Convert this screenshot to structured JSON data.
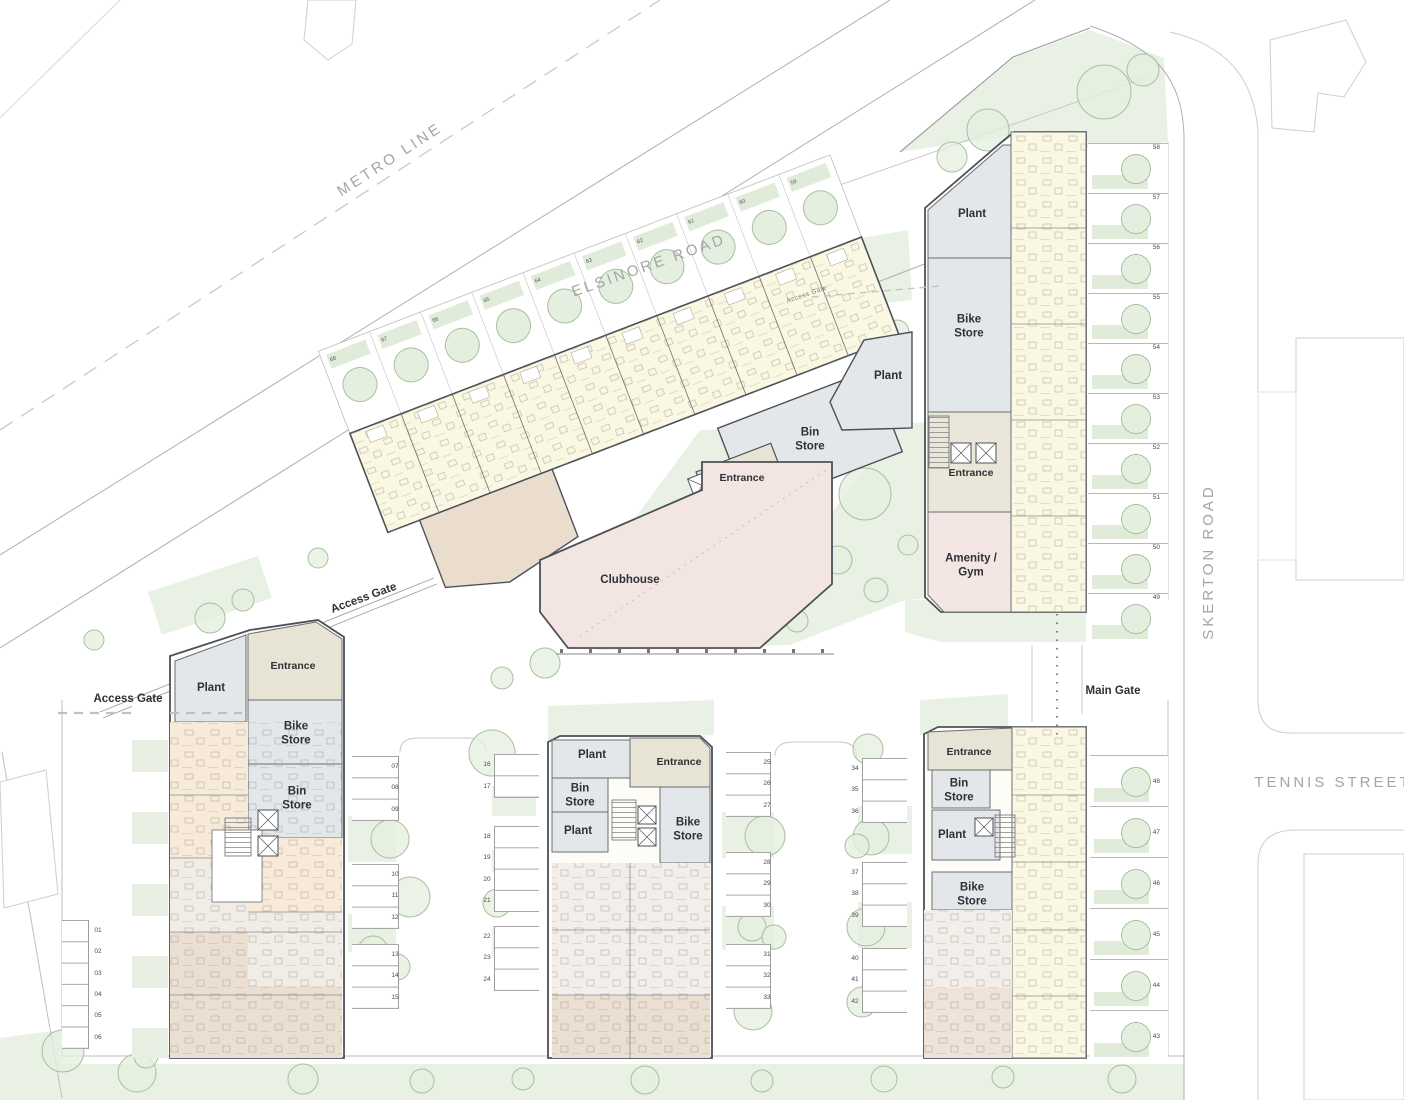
{
  "title": "Residential development site plan",
  "streets": {
    "metro": "METRO LINE",
    "elsinore": "ELSINORE ROAD",
    "skerton": "SKERTON ROAD",
    "tennis": "TENNIS STREET"
  },
  "gates": {
    "access_elsinore": "Access Gate",
    "access_west_path": "Access Gate",
    "access_west": "Access Gate",
    "main": "Main Gate"
  },
  "blocks": {
    "north_east": {
      "plant": "Plant",
      "bike_store": "Bike Store",
      "entrance": "Entrance",
      "amenity": "Amenity / Gym"
    },
    "terrace": {
      "plant": "Plant",
      "bin_store": "Bin Store",
      "entrance": "Entrance",
      "clubhouse": "Clubhouse"
    },
    "west": {
      "plant": "Plant",
      "entrance": "Entrance",
      "bike_store": "Bike Store",
      "bin_store": "Bin Store"
    },
    "central": {
      "plant_a": "Plant",
      "entrance": "Entrance",
      "bin_store": "Bin Store",
      "plant_b": "Plant",
      "bike_store": "Bike Store"
    },
    "south_east": {
      "entrance": "Entrance",
      "bin_store": "Bin Store",
      "plant": "Plant",
      "bike_store": "Bike Store"
    }
  },
  "parking": {
    "lane_a": [
      "01",
      "02",
      "03",
      "04",
      "05",
      "06"
    ],
    "lane_b1": [
      "07",
      "08",
      "09"
    ],
    "lane_b2": [
      "10",
      "11",
      "12"
    ],
    "lane_b3": [
      "13",
      "14",
      "15"
    ],
    "lane_c1": [
      "16",
      "17"
    ],
    "lane_c2": [
      "18",
      "19",
      "20",
      "21"
    ],
    "lane_c3": [
      "22",
      "23",
      "24"
    ],
    "lane_d1": [
      "25",
      "26",
      "27"
    ],
    "lane_d2": [
      "28",
      "29",
      "30"
    ],
    "lane_d3": [
      "31",
      "32",
      "33"
    ],
    "lane_e1": [
      "34",
      "35",
      "36"
    ],
    "lane_e2": [
      "37",
      "38",
      "39"
    ],
    "lane_e3": [
      "40",
      "41",
      "42"
    ]
  },
  "gardens": {
    "east": [
      "58",
      "57",
      "56",
      "55",
      "54",
      "53",
      "52",
      "51",
      "50",
      "49"
    ],
    "south_east": [
      "48",
      "47",
      "46",
      "45",
      "44",
      "43"
    ],
    "elsinore": [
      "68",
      "67",
      "66",
      "65",
      "64",
      "63",
      "62",
      "61",
      "60",
      "59"
    ]
  },
  "colors": {
    "wall": "#4d5157",
    "grey_room": "#e3e7ea",
    "beige_room": "#e7e3d5",
    "cream_unit": "#faf8e3",
    "pink_room": "#f3e6e3",
    "tan_unit": "#ebdfd2",
    "peach_unit": "#f7ead9",
    "blush_unit": "#f2ece7",
    "green": "#e9f1e4",
    "tree_line": "#a9bfa0",
    "road": "#b4b4b4"
  }
}
